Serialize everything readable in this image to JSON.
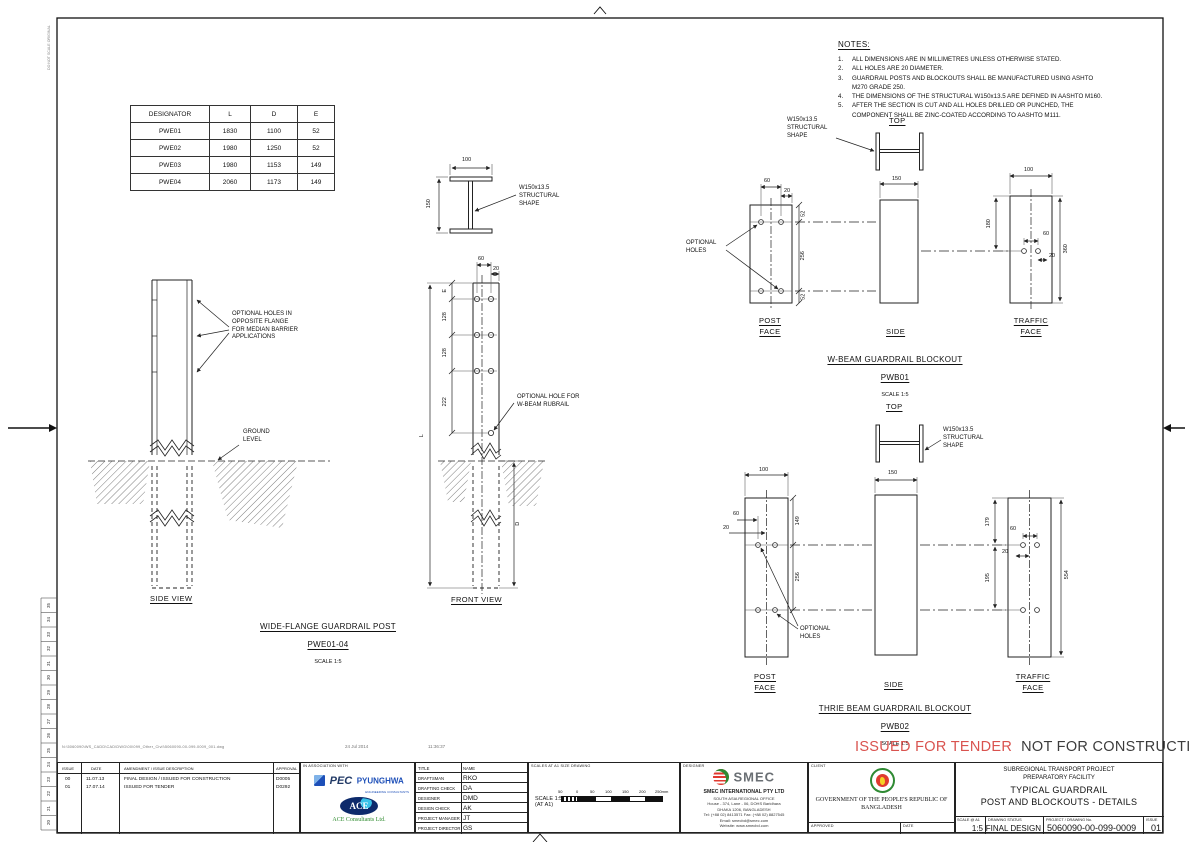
{
  "colors": {
    "stamp_red": "#d9534f",
    "pec_blue": "#1d4fb8",
    "ace_green": "#2e8b2e",
    "emblem_green": "#2f8a33",
    "emblem_red": "#e03a2f",
    "smec_gray": "#6a6f74"
  },
  "frame": {
    "vertical_note": "DO NOT SCALE ORIGINAL",
    "ruler_numbers": [
      "35",
      "34",
      "33",
      "32",
      "31",
      "30",
      "29",
      "28",
      "27",
      "26",
      "25",
      "24",
      "23",
      "22",
      "21",
      "20"
    ]
  },
  "designator_table": {
    "headers": [
      "DESIGNATOR",
      "L",
      "D",
      "E"
    ],
    "rows": [
      [
        "PWE01",
        "1830",
        "1100",
        "52"
      ],
      [
        "PWE02",
        "1980",
        "1250",
        "52"
      ],
      [
        "PWE03",
        "1980",
        "1153",
        "149"
      ],
      [
        "PWE04",
        "2060",
        "1173",
        "149"
      ]
    ]
  },
  "notes": {
    "title": "NOTES:",
    "items": [
      [
        "1.",
        "ALL DIMENSIONS ARE IN MILLIMETRES UNLESS OTHERWISE STATED."
      ],
      [
        "2.",
        "ALL HOLES ARE 20 DIAMETER."
      ],
      [
        "3.",
        "GUARDRAIL POSTS AND BLOCKOUTS SHALL BE MANUFACTURED USING ASHTO M270 GRADE 250."
      ],
      [
        "4.",
        "THE DIMENSIONS OF THE STRUCTURAL W150x13.5 ARE DEFINED IN AASHTO M160."
      ],
      [
        "5.",
        "AFTER THE SECTION IS CUT AND ALL HOLES DRILLED OR PUNCHED, THE COMPONENT SHALL BE ZINC-COATED ACCORDING TO AASHTO M111."
      ]
    ]
  },
  "side_view": {
    "optional_holes_callout": "OPTIONAL HOLES IN\nOPPOSITE FLANGE\nFOR MEDIAN BARRIER\nAPPLICATIONS",
    "ground_callout": "GROUND\nLEVEL",
    "label": "SIDE VIEW"
  },
  "post": {
    "shape_callout": "W150x13.5\nSTRUCTURAL\nSHAPE",
    "rubrail_callout": "OPTIONAL HOLE FOR\nW-BEAM RUBRAIL",
    "front_label": "FRONT VIEW",
    "title": "WIDE-FLANGE GUARDRAIL POST",
    "designators": "PWE01-04",
    "scale": "SCALE 1:5",
    "dims": {
      "flange": "100",
      "depth": "150",
      "spacing": "60",
      "edge": "20",
      "e": "E",
      "s1": "128",
      "s2": "128",
      "s3": "222",
      "length": "L",
      "embed": "D"
    }
  },
  "pwb01": {
    "top_label": "TOP",
    "shape_callout": "W150x13.5\nSTRUCTURAL\nSHAPE",
    "optional_holes": "OPTIONAL\nHOLES",
    "post_face": "POST\nFACE",
    "side": "SIDE",
    "traffic_face": "TRAFFIC\nFACE",
    "title": "W-BEAM GUARDRAIL BLOCKOUT",
    "code": "PWB01",
    "scale": "SCALE 1:5",
    "dims": {
      "spacing": "60",
      "edge": "20",
      "top": "52",
      "mid": "256",
      "bottom": "52",
      "side_width": "150",
      "face_width": "100",
      "upper": "180",
      "h60": "60",
      "h20": "20",
      "height": "360"
    }
  },
  "pwb02": {
    "top_label": "TOP",
    "shape_callout": "W150x13.5\nSTRUCTURAL\nSHAPE",
    "optional_holes": "OPTIONAL\nHOLES",
    "post_face": "POST\nFACE",
    "side": "SIDE",
    "traffic_face": "TRAFFIC\nFACE",
    "title": "THRIE BEAM GUARDRAIL BLOCKOUT",
    "code": "PWB02",
    "scale": "SCALE 1:5",
    "dims": {
      "face_width": "100",
      "spacing": "60",
      "edge": "20",
      "upper": "149",
      "mid": "256",
      "side_width": "150",
      "t_upper": "179",
      "h60": "60",
      "h20": "20",
      "t_mid": "195",
      "height": "554"
    }
  },
  "footer": {
    "file_path": "N:\\5060090\\WS_CADD\\CAD\\DWG\\00\\099_Other_Civil\\5060090-00-099-0009_001.dwg",
    "date": "24 Jul 2014",
    "time": "11:36:37",
    "stamp_red": "ISSUED FOR TENDER",
    "stamp_black": "NOT FOR CONSTRUCTION"
  },
  "titleblock": {
    "issue_table": {
      "headers": [
        "ISSUE",
        "DATE",
        "AMENDMENT / ISSUE DESCRIPTION",
        "APPROVAL"
      ],
      "rows": [
        [
          "00",
          "11.07.13",
          "FINAL DESIGN / ISSUED FOR CONSTRUCTION",
          "D0005"
        ],
        [
          "01",
          "17.07.14",
          "ISSUED FOR TENDER",
          "D0292"
        ]
      ]
    },
    "association": {
      "label": "IN ASSOCIATION WITH",
      "pec": "PEC",
      "pyunghwa": "PYUNGHWA",
      "pyunghwa_sub": "ENGINEERING CONSULTANTS",
      "ace": "ACE",
      "ace_name": "ACE Consultants Ltd."
    },
    "personnel": {
      "title_header": "TITLE",
      "name_header": "NAME",
      "rows": [
        [
          "DRAFTSMAN",
          "RKO"
        ],
        [
          "DRAFTING CHECK",
          "DA"
        ],
        [
          "DESIGNER",
          "DMD"
        ],
        [
          "DESIGN CHECK",
          "AK"
        ],
        [
          "PROJECT MANAGER",
          "JT"
        ],
        [
          "PROJECT DIRECTOR",
          "GS"
        ]
      ]
    },
    "scales": {
      "label": "SCALES AT A1 SIZE DRAWING",
      "scale_note": "SCALE 1:5\n(AT A1)",
      "ticks": [
        "50",
        "0",
        "50",
        "100",
        "150",
        "200",
        "250mm"
      ]
    },
    "designer": {
      "label": "DESIGNER",
      "logo": "SMEC",
      "company": "SMEC INTERNATIONAL PTY LTD",
      "address": [
        "SOUTH ASIA REGIONAL OFFICE",
        "House - 374, Lane - 06, DOHS Baridhara",
        "DHAKA 1206, BANGLADESH",
        "Tel: (+88 02) 8413571 Fax: (+88 02) 8827545",
        "Email: smecbd@smec.com",
        "Website: www.smecbd.com"
      ]
    },
    "client": {
      "label": "CLIENT",
      "name": "GOVERNMENT OF THE PEOPLE'S REPUBLIC OF\nBANGLADESH",
      "approved_label": "APPROVED",
      "date_label": "DATE"
    },
    "project": {
      "name": "SUBREGIONAL TRANSPORT PROJECT\nPREPARATORY FACILITY",
      "line1": "TYPICAL GUARDRAIL",
      "line2": "POST AND BLOCKOUTS - DETAILS",
      "scale_label": "SCALE  @ A1",
      "scale": "1:5",
      "status_label": "DRAWING STATUS",
      "status": "FINAL DESIGN",
      "number_label": "PROJECT / DRAWING No.",
      "number": "5060090-00-099-0009",
      "issue_label": "ISSUE",
      "issue": "01"
    }
  }
}
